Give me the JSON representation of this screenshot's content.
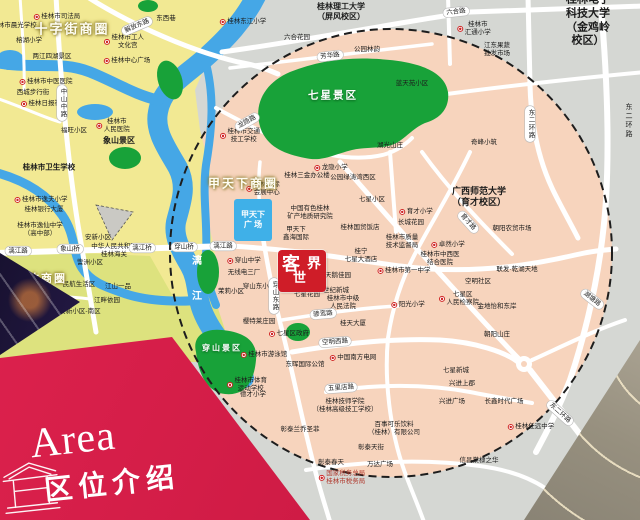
{
  "banner": {
    "en": "Area",
    "zh": "区位介绍",
    "color": "#d11c46"
  },
  "logo": {
    "c1": "客",
    "c2": "世",
    "c3": "界",
    "color": "#cf1d28"
  },
  "colors": {
    "circle_fill": "#f7d4bd",
    "outside_gray": "#d5d7d3",
    "district_yellow": "#f2e993",
    "district_yellowgreen": "#dde27e",
    "park_green": "#18a239",
    "river_blue": "#45a7e6",
    "road_white": "#ffffff",
    "plaza_blue": "#3fb0e8"
  },
  "map": {
    "plaza": {
      "label": "甲天下\n广 场"
    },
    "business_circles": [
      {
        "t": "十字街商圈",
        "x": 72,
        "y": 28,
        "fs": 13
      },
      {
        "t": "甲天下商圈",
        "x": 243,
        "y": 183,
        "fs": 12
      },
      {
        "t": "联达商圈",
        "x": 41,
        "y": 278,
        "fs": 11
      }
    ],
    "park_labels": [
      {
        "t": "七星景区",
        "x": 333,
        "y": 95,
        "fs": 10.5
      },
      {
        "t": "穿山景区",
        "x": 222,
        "y": 348,
        "fs": 8
      }
    ],
    "road_labels": [
      {
        "t": "解放东路",
        "x": 137,
        "y": 26,
        "r": -23
      },
      {
        "t": "漓江路",
        "x": 18,
        "y": 251
      },
      {
        "t": "象山桥",
        "x": 70,
        "y": 249
      },
      {
        "t": "漓江桥",
        "x": 142,
        "y": 248
      },
      {
        "t": "穿山桥",
        "x": 184,
        "y": 247
      },
      {
        "t": "漓江路",
        "x": 223,
        "y": 246
      },
      {
        "t": "六合路",
        "x": 456,
        "y": 12,
        "r": -6
      },
      {
        "t": "芳华路",
        "x": 330,
        "y": 56,
        "r": -7
      },
      {
        "t": "龙隐路",
        "x": 247,
        "y": 122,
        "r": -30
      },
      {
        "t": "东二环路",
        "x": 530,
        "y": 124,
        "v": 1
      },
      {
        "t": "中山中路",
        "x": 62,
        "y": 103,
        "v": 1
      },
      {
        "t": "育才路",
        "x": 468,
        "y": 222,
        "r": 48
      },
      {
        "t": "穿山东路",
        "x": 274,
        "y": 296,
        "v": 1
      },
      {
        "t": "骖鸾路",
        "x": 323,
        "y": 314,
        "r": -5
      },
      {
        "t": "空明西路",
        "x": 335,
        "y": 342,
        "r": -4
      },
      {
        "t": "五里店路",
        "x": 341,
        "y": 388,
        "r": -4
      },
      {
        "t": "湖塘路",
        "x": 592,
        "y": 299,
        "r": 38
      },
      {
        "t": "东二环路",
        "x": 560,
        "y": 413,
        "r": 42
      }
    ],
    "road_texts": [
      {
        "t": "东二环路",
        "x": 628,
        "y": 121,
        "v": 1
      }
    ],
    "pois": [
      {
        "t": "桂林市司法局",
        "x": 57,
        "y": 17,
        "d": 1
      },
      {
        "t": "桂林市晨光学校",
        "x": 14,
        "y": 26
      },
      {
        "t": "东西巷",
        "x": 166,
        "y": 19
      },
      {
        "t": "桂林市工人\n文化宫",
        "x": 124,
        "y": 42,
        "d": 1
      },
      {
        "t": "桂林中心广场",
        "x": 127,
        "y": 61,
        "d": 1
      },
      {
        "t": "榕湖小学",
        "x": 29,
        "y": 41
      },
      {
        "t": "两江四湖景区",
        "x": 52,
        "y": 57
      },
      {
        "t": "桂林市中医医院",
        "x": 46,
        "y": 82,
        "d": 1
      },
      {
        "t": "西城步行街",
        "x": 33,
        "y": 93
      },
      {
        "t": "桂林日报社",
        "x": 41,
        "y": 104,
        "d": 1
      },
      {
        "t": "桂林市\n人民医院",
        "x": 113,
        "y": 126,
        "d": 1
      },
      {
        "t": "象山景区",
        "x": 119,
        "y": 141,
        "b": 1,
        "fs": 8
      },
      {
        "t": "福旺小区",
        "x": 74,
        "y": 131
      },
      {
        "t": "桂林市卫生学校",
        "x": 49,
        "y": 167,
        "b": 1,
        "fs": 7.5
      },
      {
        "t": "桂林市逸夫小学",
        "x": 41,
        "y": 200,
        "d": 1
      },
      {
        "t": "桂林银行大厦",
        "x": 44,
        "y": 210
      },
      {
        "t": "桂林市逸仙中学\n（高中部）",
        "x": 40,
        "y": 230
      },
      {
        "t": "安新小区",
        "x": 98,
        "y": 238
      },
      {
        "t": "中华人民共和国\n桂林海关",
        "x": 114,
        "y": 251
      },
      {
        "t": "訾洲小区",
        "x": 90,
        "y": 263
      },
      {
        "t": "民航生活区",
        "x": 79,
        "y": 285
      },
      {
        "t": "江山一品",
        "x": 118,
        "y": 287
      },
      {
        "t": "江畔依园",
        "x": 107,
        "y": 301
      },
      {
        "t": "安新小区-南区",
        "x": 80,
        "y": 312
      },
      {
        "t": "漓",
        "x": 197,
        "y": 262,
        "c": "#ffffff",
        "fs": 10,
        "b": 1
      },
      {
        "t": "江",
        "x": 197,
        "y": 297,
        "c": "#ffffff",
        "fs": 10,
        "b": 1
      },
      {
        "t": "桂林东江小学",
        "x": 243,
        "y": 22,
        "d": 1
      },
      {
        "t": "桂林理工大学\n（屏风校区）",
        "x": 341,
        "y": 12,
        "b": 1,
        "fs": 8
      },
      {
        "t": "六合花园",
        "x": 297,
        "y": 38
      },
      {
        "t": "公园林韵",
        "x": 367,
        "y": 50
      },
      {
        "t": "蓝天苑小区",
        "x": 412,
        "y": 84
      },
      {
        "t": "湖光山庄",
        "x": 390,
        "y": 146
      },
      {
        "t": "桂林市交通\n技工学校",
        "x": 240,
        "y": 136,
        "d": 1
      },
      {
        "t": "桂林电子科技大学\n（金鸡岭校区）",
        "x": 588,
        "y": 21,
        "b": 1,
        "fs": 11
      },
      {
        "t": "桂林市\n汇通小学",
        "x": 474,
        "y": 29,
        "d": 1
      },
      {
        "t": "江东果蔬\n批发市场",
        "x": 497,
        "y": 50
      },
      {
        "t": "奇峰小筑",
        "x": 484,
        "y": 143
      },
      {
        "t": "桂林国际\n会展中心",
        "x": 263,
        "y": 189,
        "d": 1
      },
      {
        "t": "桂林三金办公楼",
        "x": 307,
        "y": 176
      },
      {
        "t": "中国有色桂林\n矿产地质研究院",
        "x": 310,
        "y": 213
      },
      {
        "t": "桂林国贸饭店",
        "x": 360,
        "y": 228
      },
      {
        "t": "甲天下\n鑫海国际",
        "x": 296,
        "y": 234
      },
      {
        "t": "七星小区",
        "x": 372,
        "y": 200
      },
      {
        "t": "龙隐小学",
        "x": 331,
        "y": 168,
        "d": 1
      },
      {
        "t": "公园绿涛湾西区",
        "x": 353,
        "y": 178
      },
      {
        "t": "育才小学",
        "x": 416,
        "y": 212,
        "d": 1
      },
      {
        "t": "长城花园",
        "x": 411,
        "y": 223
      },
      {
        "t": "桂林市质量\n技术监督局",
        "x": 402,
        "y": 242
      },
      {
        "t": "桂林市第一中学",
        "x": 404,
        "y": 271,
        "d": 1
      },
      {
        "t": "桂宁\n七星大酒店",
        "x": 361,
        "y": 256
      },
      {
        "t": "天鹅佳园",
        "x": 338,
        "y": 276
      },
      {
        "t": "世纪新城",
        "x": 336,
        "y": 291
      },
      {
        "t": "桂林市中级\n人民法院",
        "x": 343,
        "y": 303
      },
      {
        "t": "穿山中学",
        "x": 244,
        "y": 261,
        "d": 1
      },
      {
        "t": "无线电三厂",
        "x": 244,
        "y": 273
      },
      {
        "t": "茉莉小区",
        "x": 231,
        "y": 292
      },
      {
        "t": "穿山东小区",
        "x": 259,
        "y": 287
      },
      {
        "t": "七星花园",
        "x": 307,
        "y": 295
      },
      {
        "t": "樱特莱庄园",
        "x": 259,
        "y": 322
      },
      {
        "t": "桂天大厦",
        "x": 353,
        "y": 324
      },
      {
        "t": "阳光小学",
        "x": 408,
        "y": 305,
        "d": 1
      },
      {
        "t": "广西师范大学\n（育才校区）",
        "x": 479,
        "y": 197,
        "b": 1,
        "fs": 9
      },
      {
        "t": "朝阳农贸市场",
        "x": 512,
        "y": 229
      },
      {
        "t": "卓然小学",
        "x": 448,
        "y": 245,
        "d": 1
      },
      {
        "t": "桂林市中西医\n结合医院",
        "x": 440,
        "y": 259
      },
      {
        "t": "空明社区",
        "x": 478,
        "y": 282
      },
      {
        "t": "七星区\n人民检察院",
        "x": 459,
        "y": 299,
        "d": 1
      },
      {
        "t": "金地怡和东岸",
        "x": 497,
        "y": 307
      },
      {
        "t": "联发·乾湖天地",
        "x": 517,
        "y": 270
      },
      {
        "t": "七星区政府",
        "x": 289,
        "y": 334,
        "d": 1
      },
      {
        "t": "中国南方电网",
        "x": 353,
        "y": 358,
        "d": 1
      },
      {
        "t": "东晖国际公馆",
        "x": 305,
        "y": 365
      },
      {
        "t": "桂林市游泳馆",
        "x": 264,
        "y": 355,
        "d": 1
      },
      {
        "t": "桂林市体育\n运动学校",
        "x": 247,
        "y": 385,
        "d": 1
      },
      {
        "t": "德才小学",
        "x": 253,
        "y": 395
      },
      {
        "t": "桂林技师学院\n（桂林高级技工学校）",
        "x": 345,
        "y": 406
      },
      {
        "t": "彰泰兰乔圣菲",
        "x": 300,
        "y": 430
      },
      {
        "t": "百事可乐饮料\n（桂林）有限公司",
        "x": 394,
        "y": 429
      },
      {
        "t": "彰泰天街",
        "x": 371,
        "y": 448
      },
      {
        "t": "彰泰春天",
        "x": 331,
        "y": 463
      },
      {
        "t": "万达广场",
        "x": 380,
        "y": 465
      },
      {
        "t": "国家税务总局\n桂林市税务局",
        "x": 342,
        "y": 478,
        "c": "#b03a2e",
        "d": 1
      },
      {
        "t": "朝阳山庄",
        "x": 497,
        "y": 335
      },
      {
        "t": "七星新城",
        "x": 456,
        "y": 371
      },
      {
        "t": "兴进上郡",
        "x": 462,
        "y": 384
      },
      {
        "t": "兴进广场",
        "x": 452,
        "y": 402
      },
      {
        "t": "长鑫时代广场",
        "x": 504,
        "y": 402
      },
      {
        "t": "桂林任远中学",
        "x": 531,
        "y": 427,
        "d": 1
      },
      {
        "t": "信昌棠棣之华",
        "x": 479,
        "y": 461
      }
    ]
  }
}
